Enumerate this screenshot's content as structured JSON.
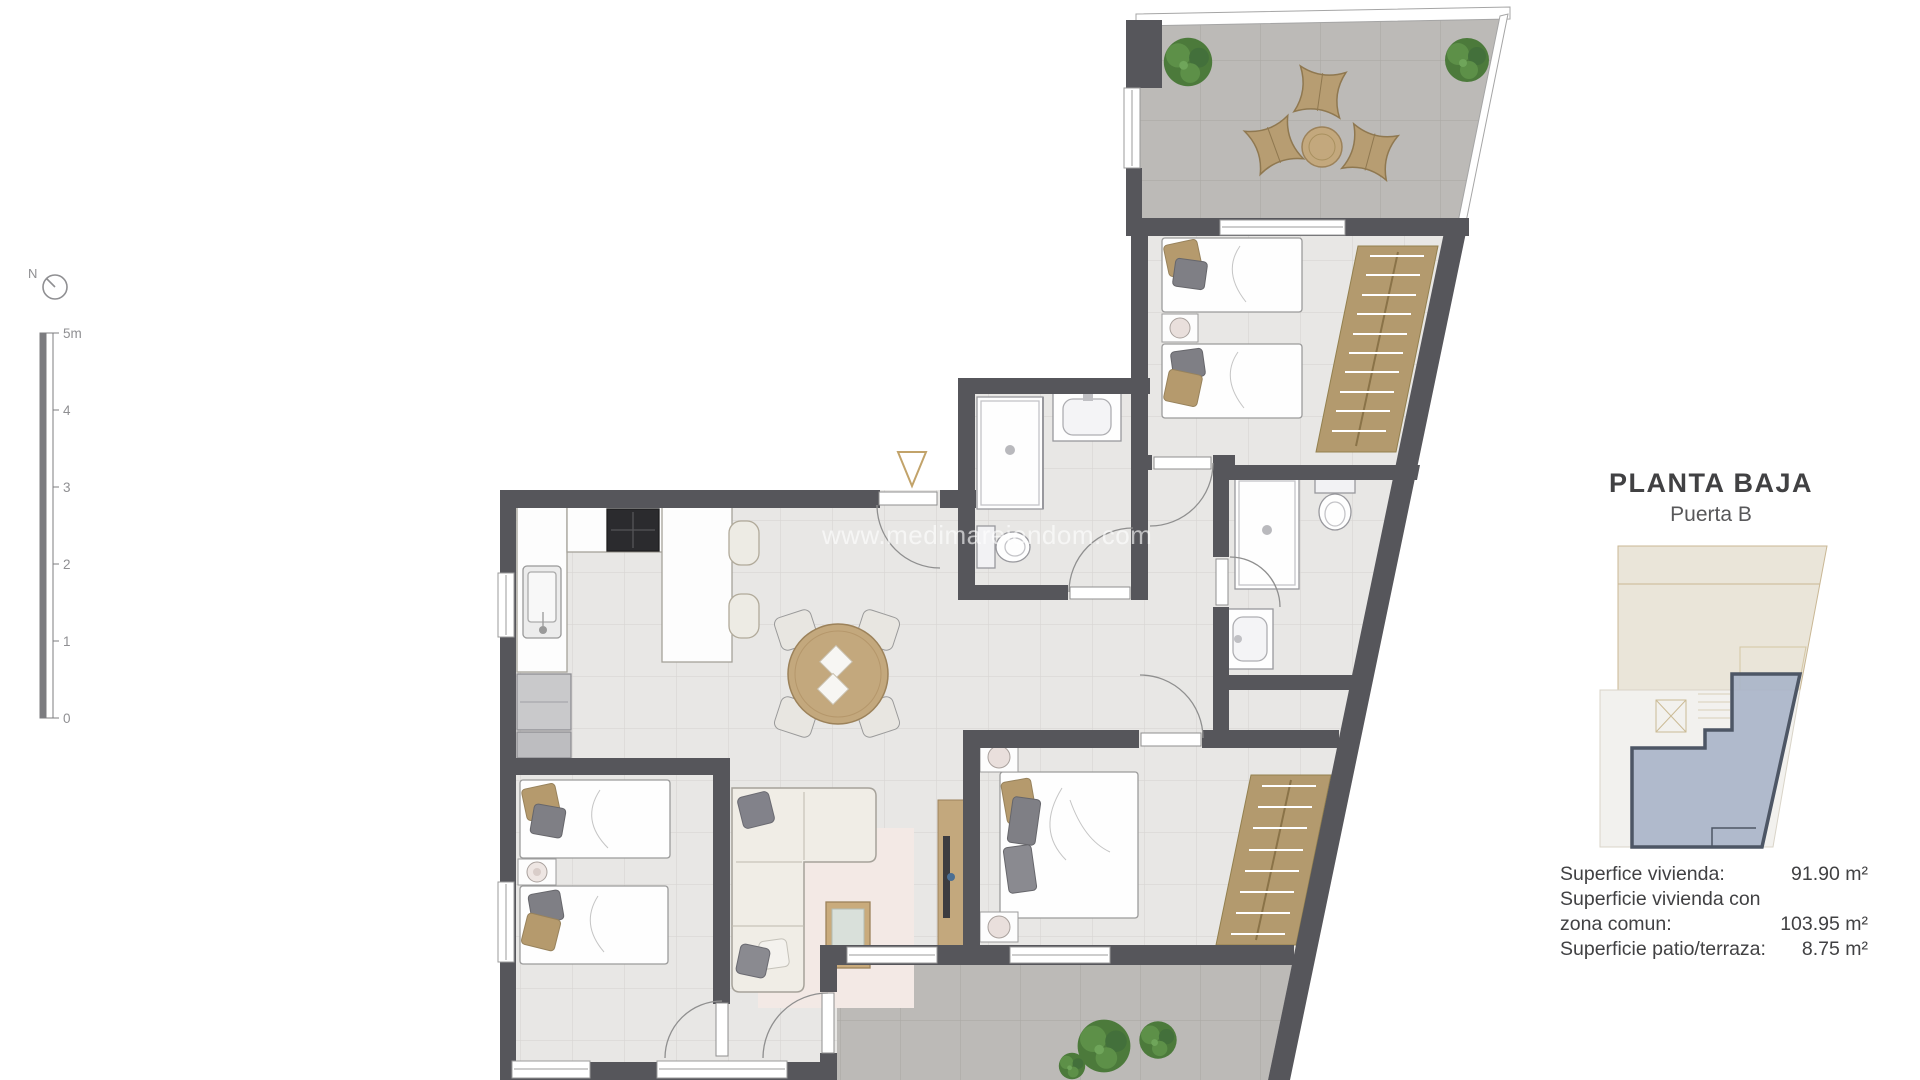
{
  "header": {
    "title": "PLANTA BAJA",
    "subtitle": "Puerta B"
  },
  "areas": {
    "rows": [
      {
        "label": "Superfice vivienda:",
        "value": "91.90 m²"
      },
      {
        "label": "Superficie vivienda con",
        "value": ""
      },
      {
        "label": "zona comun:",
        "value": "103.95 m²"
      },
      {
        "label": "Superficie patio/terraza:",
        "value": "8.75 m²"
      }
    ]
  },
  "scale": {
    "labels": [
      "5m",
      "4",
      "3",
      "2",
      "1",
      "0"
    ]
  },
  "compass": {
    "label": "N"
  },
  "watermark": {
    "text": "www.medimareiendom.com"
  },
  "colors": {
    "wall": "#56565b",
    "floor": "#e8e7e5",
    "floor-line": "#d8d6d3",
    "terrace": "#bcbab7",
    "terrace-line": "#abaaa6",
    "wood": "#c3a87d",
    "wood-dark": "#9c825a",
    "wardrobe": "#b39a6e",
    "wardrobe-line": "#93804f",
    "green-1": "#4c7a3b",
    "green-2": "#5d9048",
    "green-3": "#43703b",
    "rug": "#f3e9e5",
    "sofa": "#f0ede6",
    "furn-stroke": "#a5a29a",
    "fixture-stroke": "#98989d",
    "stove": "#2b2b2e",
    "tv": "#3c3c40",
    "accent-tan": "#c2a36a",
    "unit-fill": "#a9b4c8",
    "unit-stroke": "#4d5665",
    "kp-beige": "#eae5d9",
    "kp-beige-line": "#c9b794",
    "kp-gray": "#f2f1ee",
    "kp-gray-line": "#d9d4c8",
    "text": "#414143",
    "text-light": "#58585a"
  }
}
